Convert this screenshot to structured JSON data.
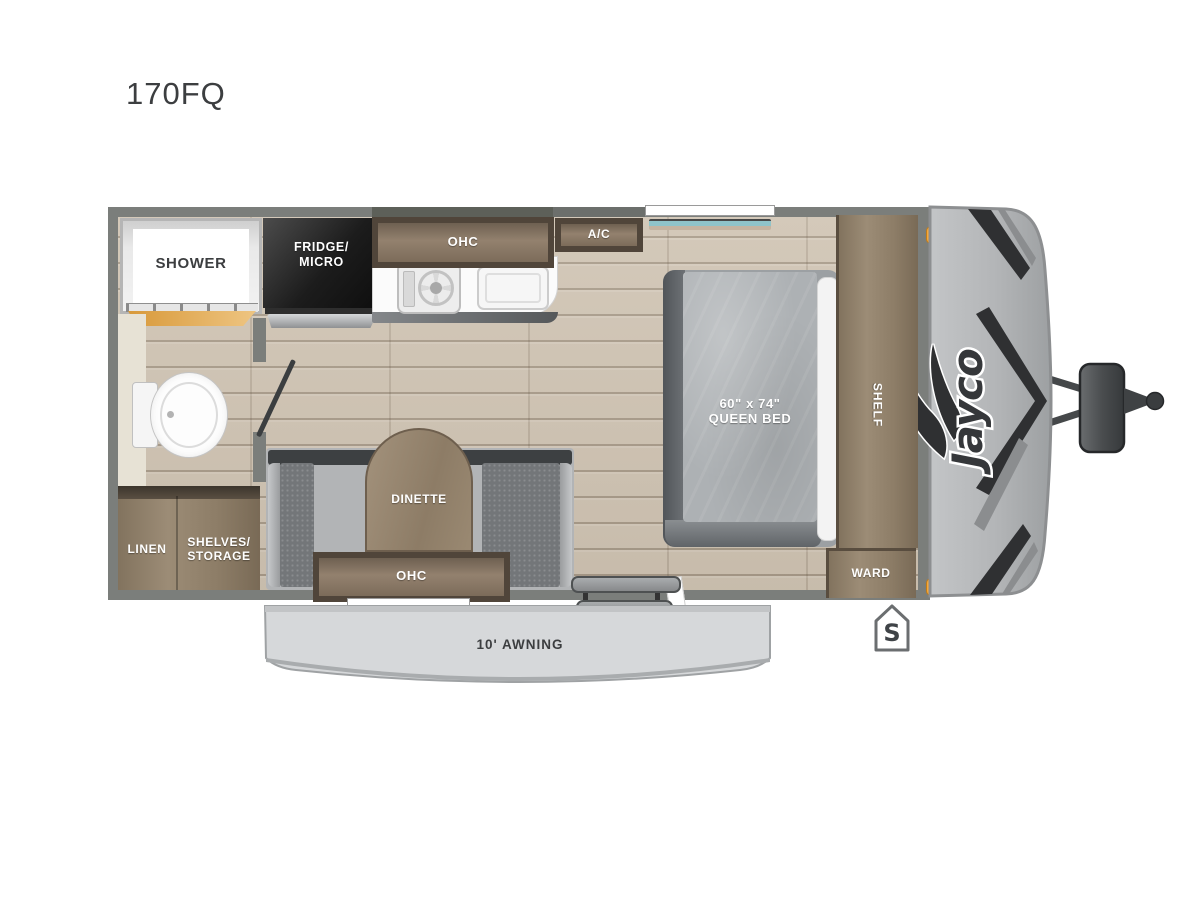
{
  "title": "170FQ",
  "brand": {
    "name": "Jayco"
  },
  "colors": {
    "wall": "#7b7e7b",
    "floor": "#cfc3b2",
    "wood": "#96866f",
    "accent_orange": "#f6a83c",
    "front_cap": "#b5b7b9",
    "awning": "#d6d8da"
  },
  "labels": {
    "shower": "SHOWER",
    "fridge_line1": "FRIDGE/",
    "fridge_line2": "MICRO",
    "kitchen_ohc": "OHC",
    "ac": "A/C",
    "bed_line1": "60\" x 74\"",
    "bed_line2": "QUEEN BED",
    "shelf": "SHELF",
    "ward": "WARD",
    "dinette": "DINETTE",
    "dinette_ohc": "OHC",
    "linen": "LINEN",
    "storage_line1": "SHELVES/",
    "storage_line2": "STORAGE",
    "awning": "10' AWNING",
    "spare_badge": "S"
  }
}
